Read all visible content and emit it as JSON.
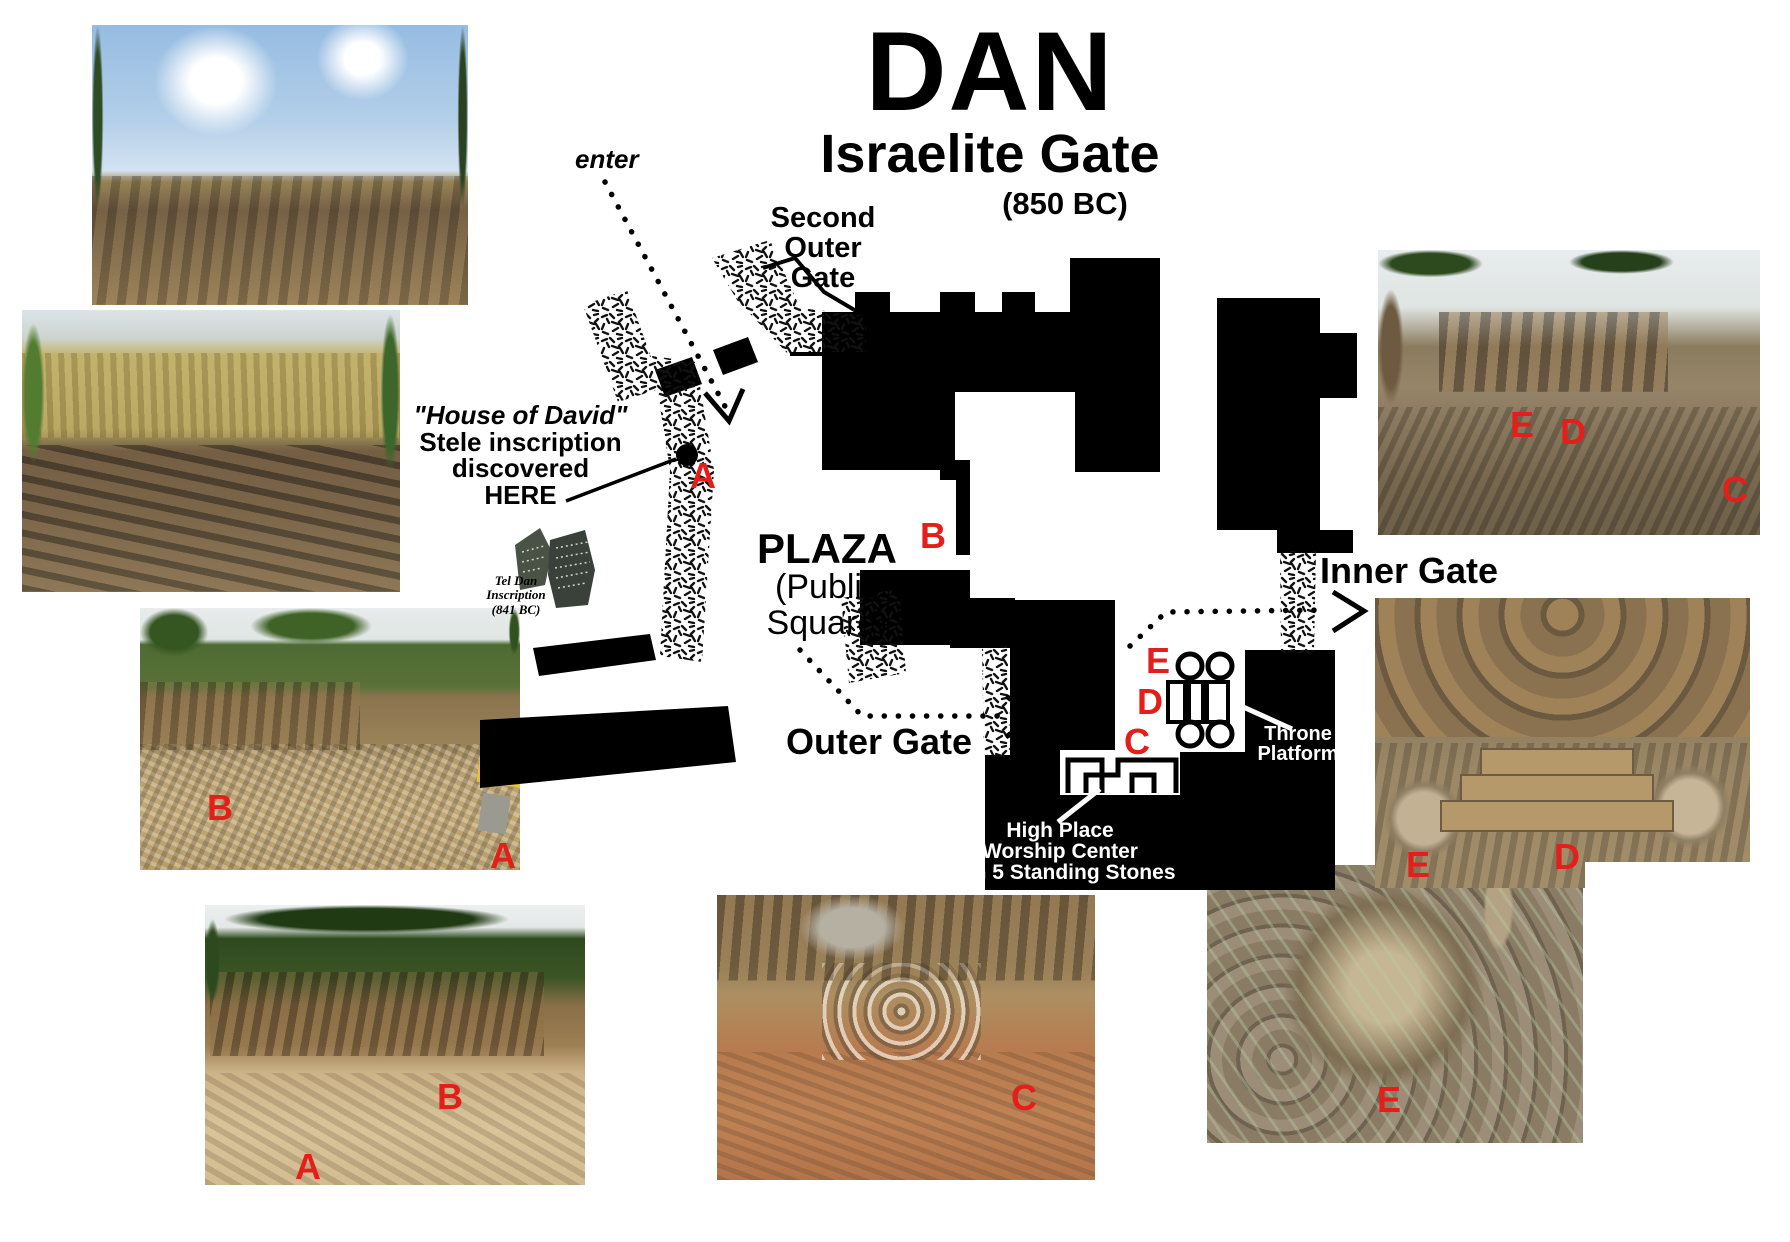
{
  "title": {
    "main": "DAN",
    "subtitle": "Israelite Gate",
    "year": "(850 BC)"
  },
  "plan_labels": {
    "enter": "enter",
    "second_outer_gate": [
      "Second",
      "Outer",
      "Gate"
    ],
    "stele_note": [
      "\"House of David\"",
      "Stele inscription",
      "discovered",
      "HERE"
    ],
    "inscription_caption": [
      "Tel Dan",
      "Inscription",
      "(841 BC)"
    ],
    "plaza": [
      "PLAZA",
      "(Public",
      "Square)"
    ],
    "outer_gate": "Outer Gate",
    "inner_gate": "Inner Gate",
    "throne_platform": [
      "Throne",
      "Platform"
    ],
    "high_place": [
      "High Place",
      "Worship Center",
      "with 5 Standing Stones"
    ]
  },
  "markers": {
    "A": "A",
    "B": "B",
    "C": "C",
    "D": "D",
    "E": "E"
  },
  "colors": {
    "marker_red": "#e41e1a",
    "plan_black": "#000000",
    "sign_yellow": "#e3c43a"
  }
}
